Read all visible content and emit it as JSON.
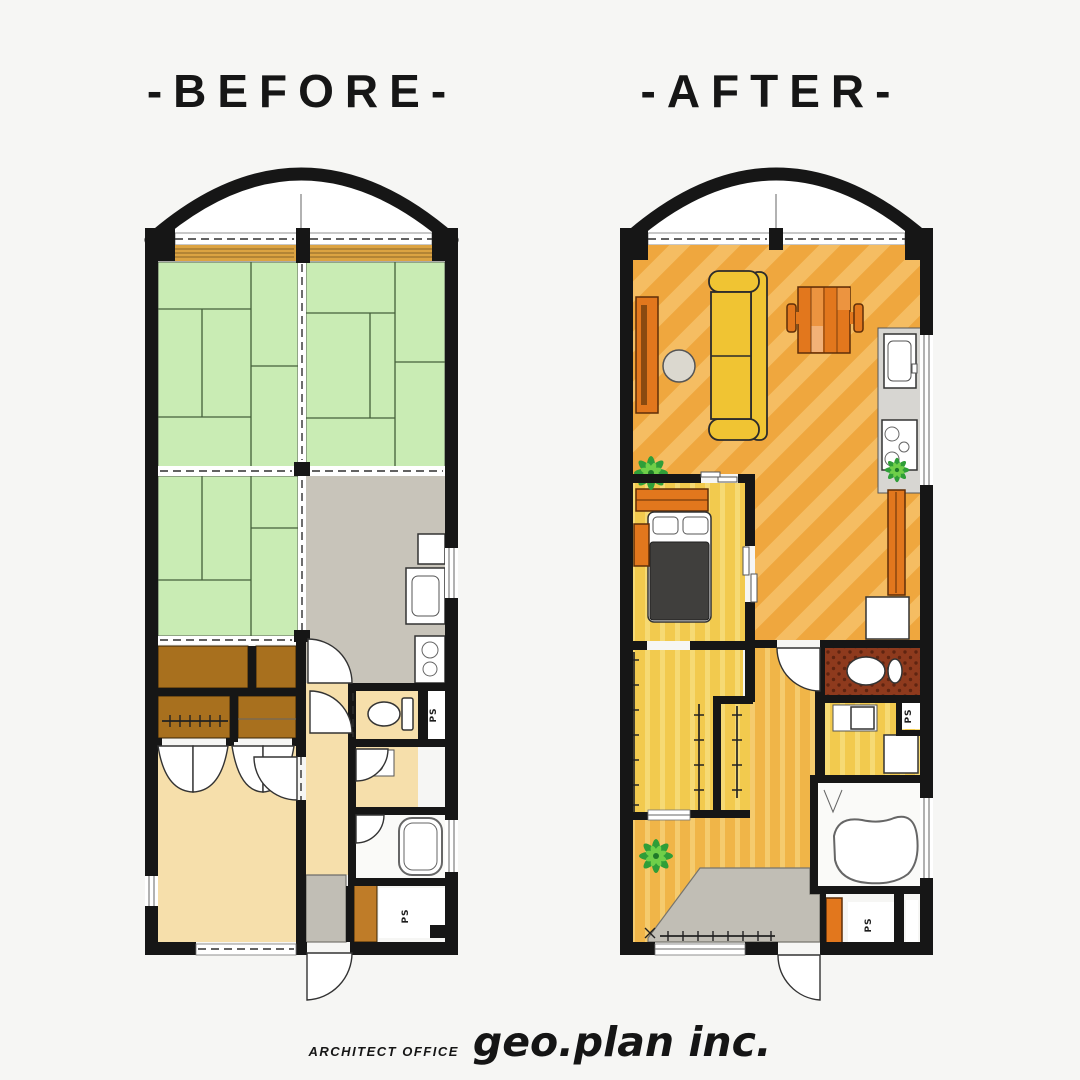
{
  "titles": {
    "before": "-BEFORE-",
    "after": "-AFTER-"
  },
  "footer": {
    "office_type": "ARCHITECT OFFICE",
    "company": "geo.plan inc."
  },
  "labels": {
    "pipe_space": "PS"
  },
  "palette": {
    "bg": "#f6f6f4",
    "wall": "#161616",
    "tatami": "#c9ecb4",
    "tatamiLine": "#44603a",
    "engawa": "#dca342",
    "engawaLine": "#8a6428",
    "kitchenGray": "#c8c4ba",
    "tan": "#f6dfab",
    "closetBrown": "#a8701e",
    "shoeCabinet": "#bf7c28",
    "entryGray": "#c1beb5",
    "ldkBase": "#efa73e",
    "ldkStripe": "#f5bd62",
    "yellowBase": "#f2ca4e",
    "yellowStripe": "#f6da74",
    "hallBase": "#f0b548",
    "hallStripe": "#f5cb6e",
    "toiletRed": "#8e3a1d",
    "toiletDot": "#5f2410",
    "furnOrange": "#e2771d",
    "furnOrangeDark": "#5f2e08",
    "sofaYellow": "#f0c433",
    "tableGray": "#dbd8cf",
    "bedDark": "#403f3d",
    "plantGreen": "#2f9e38",
    "plantLight": "#6fcf49"
  }
}
